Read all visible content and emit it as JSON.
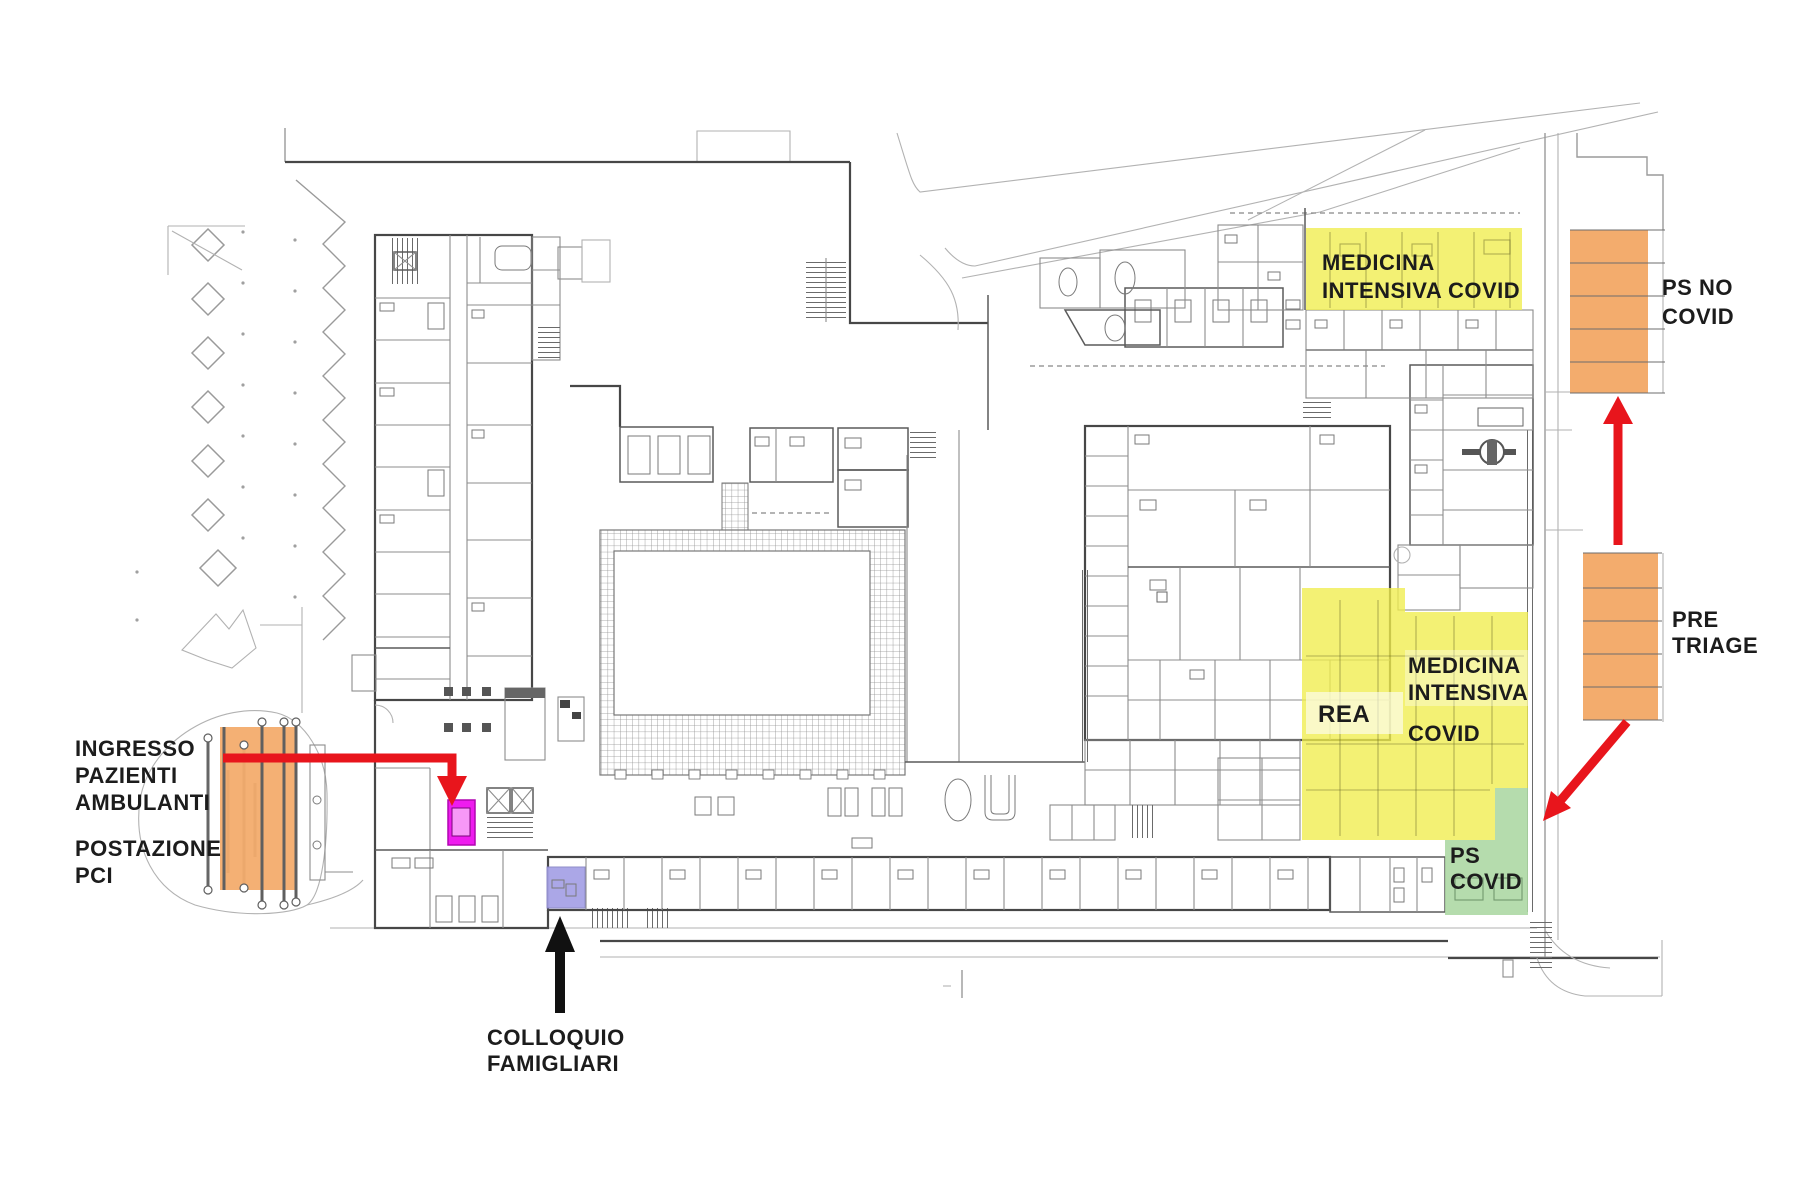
{
  "figure": {
    "type": "hospital-floor-plan",
    "description": "Architectural plan of a hospital ground floor with highlighted COVID emergency zones, entrances and patient flow arrows"
  },
  "labels": {
    "ingresso_pazienti": {
      "lines": [
        "INGRESSO",
        "PAZIENTI",
        "AMBULANTI"
      ]
    },
    "postazione_pci": {
      "lines": [
        "POSTAZIONE",
        "PCI"
      ]
    },
    "colloquio_famigliari": {
      "lines": [
        "COLLOQUIO",
        "FAMIGLIARI"
      ]
    },
    "medicina_intensiva_covid_top": {
      "lines": [
        "MEDICINA",
        "INTENSIVA COVID"
      ]
    },
    "medicina_intensiva_covid_mid": {
      "lines": [
        "MEDICINA",
        "INTENSIVA",
        "COVID"
      ]
    },
    "rea": {
      "lines": [
        "REA"
      ]
    },
    "ps_covid": {
      "lines": [
        "PS",
        "COVID"
      ]
    },
    "ps_no_covid": {
      "lines": [
        "PS NO",
        "COVID"
      ]
    },
    "pre_triage": {
      "lines": [
        "PRE",
        "TRIAGE"
      ]
    }
  },
  "zones": [
    {
      "id": "medicina-intensiva-covid-top",
      "label": "MEDICINA INTENSIVA COVID",
      "color": "#efed4d"
    },
    {
      "id": "rea-medicina-intensiva-covid",
      "label": "REA / MEDICINA INTENSIVA COVID",
      "color": "#efed4d"
    },
    {
      "id": "ps-covid",
      "label": "PS COVID",
      "color": "#abd7a2"
    },
    {
      "id": "ps-no-covid",
      "label": "PS NO COVID",
      "color": "#f3ac6d"
    },
    {
      "id": "pre-triage",
      "label": "PRE TRIAGE",
      "color": "#f3ac6d"
    },
    {
      "id": "postazione-pci-canopy",
      "label": "INGRESSO PAZIENTI AMBULANTI / POSTAZIONE PCI",
      "color": "#f3ac6d"
    },
    {
      "id": "ingresso-marker",
      "label": "ingresso pazienti ambulanti marker",
      "color": "#ee1cee"
    },
    {
      "id": "colloquio-famigliari-room",
      "label": "COLLOQUIO FAMIGLIARI",
      "color": "#a7a3e6"
    }
  ],
  "annotation_colors": {
    "arrow_red": "#e8151c",
    "arrow_black": "#111111",
    "text": "#1c1c1c"
  }
}
